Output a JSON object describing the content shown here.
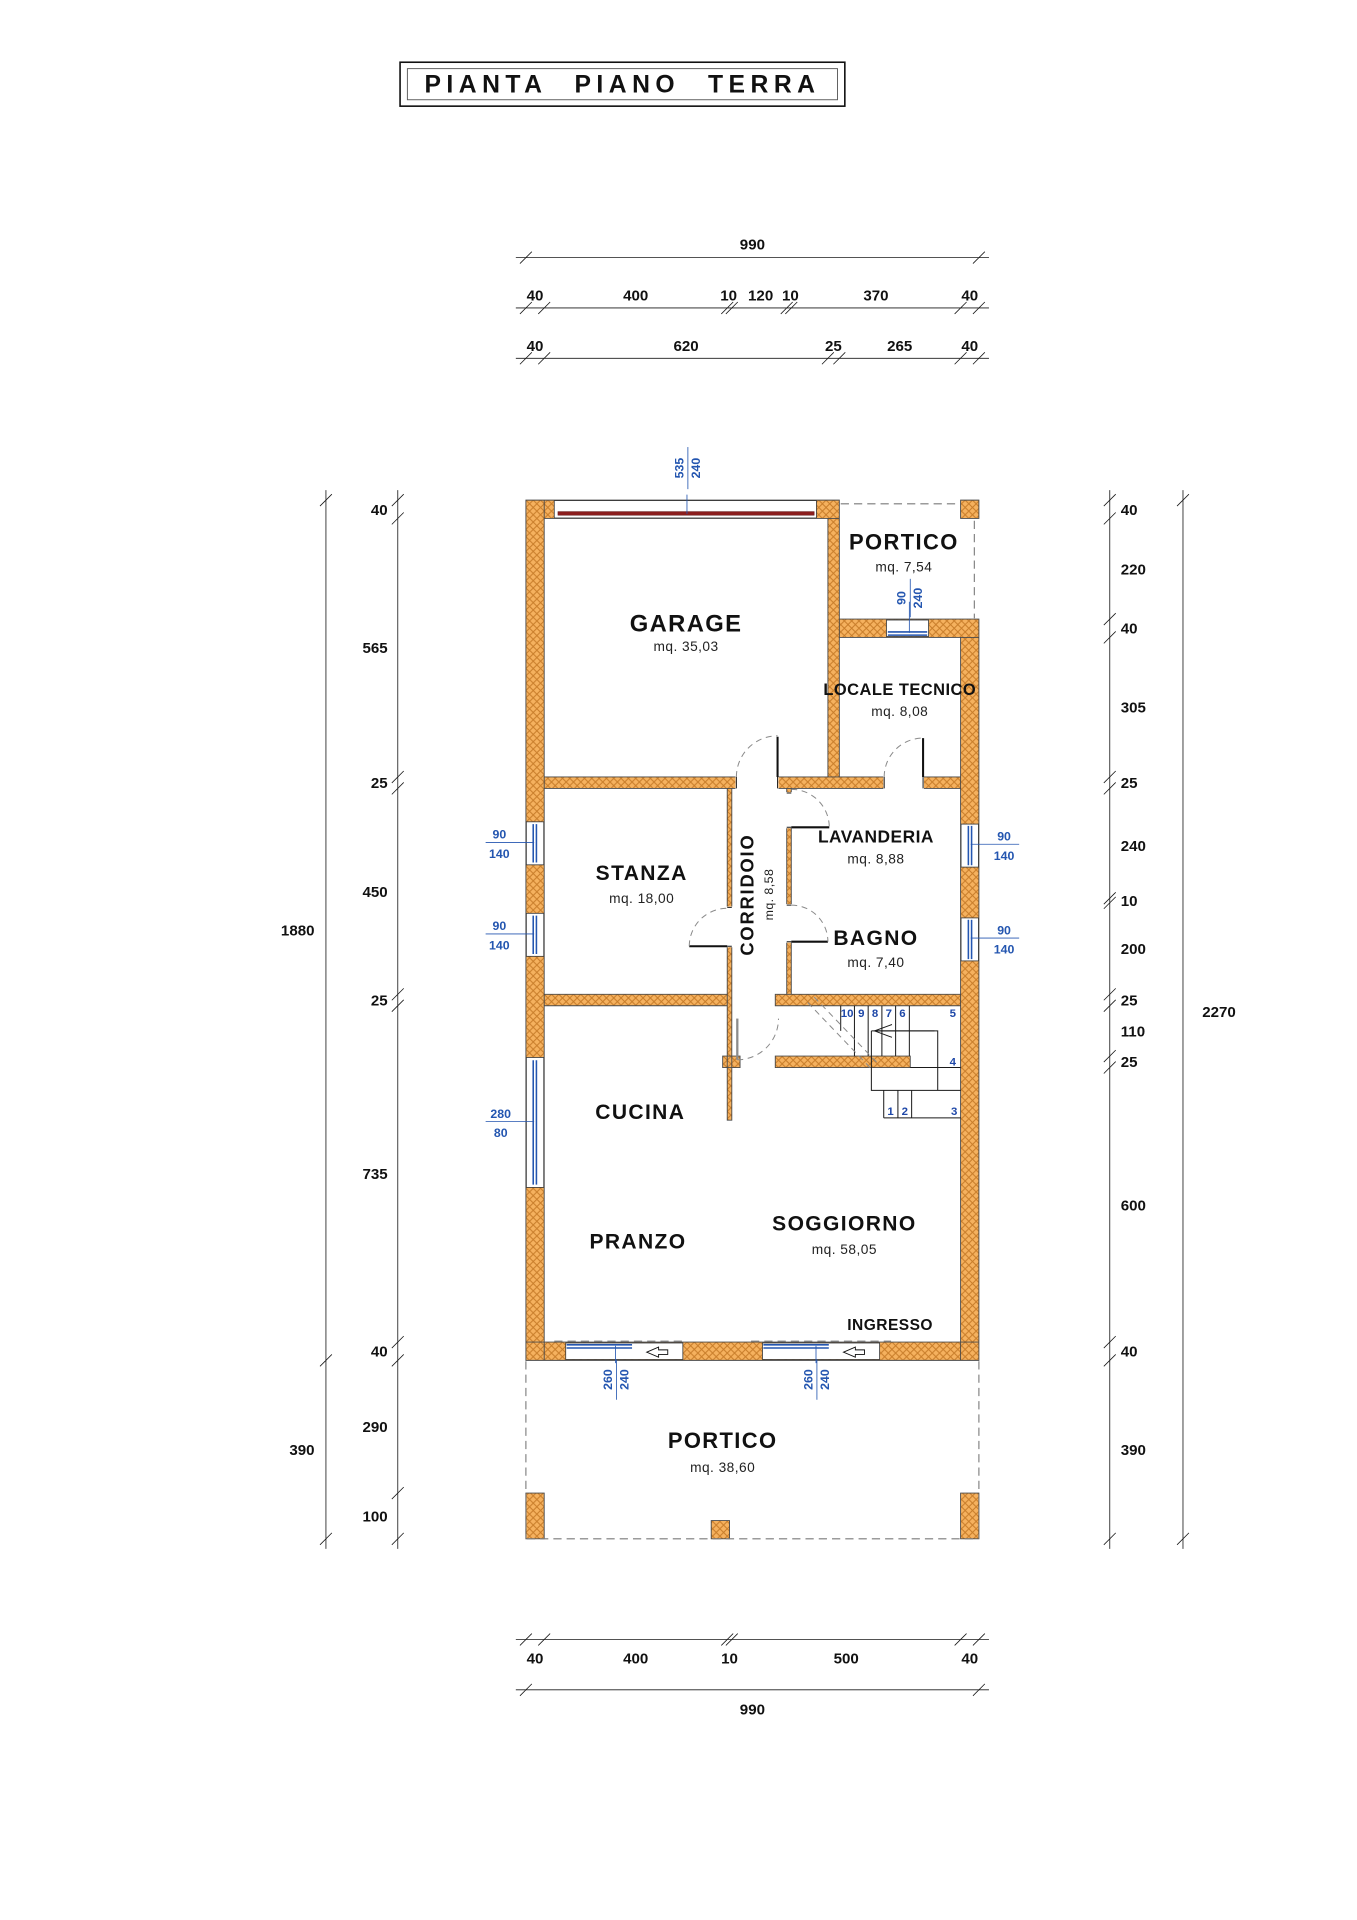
{
  "title": "PIANTA PIANO TERRA",
  "rooms": {
    "garage": {
      "name": "GARAGE",
      "area": "mq. 35,03"
    },
    "portico_top": {
      "name": "PORTICO",
      "area": "mq. 7,54"
    },
    "locale_tecnico": {
      "name": "LOCALE TECNICO",
      "area": "mq. 8,08"
    },
    "lavanderia": {
      "name": "LAVANDERIA",
      "area": "mq. 8,88"
    },
    "bagno": {
      "name": "BAGNO",
      "area": "mq. 7,40"
    },
    "corridoio": {
      "name": "CORRIDOIO",
      "area": "mq. 8,58"
    },
    "stanza": {
      "name": "STANZA",
      "area": "mq. 18,00"
    },
    "cucina": {
      "name": "CUCINA"
    },
    "pranzo": {
      "name": "PRANZO"
    },
    "soggiorno": {
      "name": "SOGGIORNO",
      "area": "mq. 58,05"
    },
    "ingresso": {
      "name": "INGRESSO"
    },
    "portico_bottom": {
      "name": "PORTICO",
      "area": "mq. 38,60"
    }
  },
  "openings": {
    "garage_door": {
      "w": "535",
      "h": "240"
    },
    "portico_door": {
      "w": "90",
      "h": "240"
    },
    "window_small": {
      "w": "90",
      "h": "140"
    },
    "window_kitchen": {
      "w": "280",
      "h": "80"
    },
    "south_door": {
      "w": "260",
      "h": "240"
    }
  },
  "stairs": {
    "numbers": [
      "1",
      "2",
      "3",
      "4",
      "5",
      "6",
      "7",
      "8",
      "9",
      "10"
    ]
  },
  "dimensions": {
    "top_overall": "990",
    "top_row2": [
      "40",
      "400",
      "10",
      "120",
      "10",
      "370",
      "40"
    ],
    "top_row3": [
      "40",
      "620",
      "25",
      "265",
      "40"
    ],
    "bottom_row": [
      "40",
      "400",
      "10",
      "500",
      "40"
    ],
    "bottom_overall": "990",
    "left_segments": [
      "40",
      "565",
      "25",
      "450",
      "25",
      "735",
      "40",
      "290",
      "100"
    ],
    "left_overall": "1880",
    "left_portico": "390",
    "right_segments": [
      "40",
      "220",
      "40",
      "305",
      "25",
      "240",
      "10",
      "200",
      "25",
      "110",
      "25",
      "600",
      "40",
      "390"
    ],
    "right_overall": "2270"
  },
  "colors": {
    "wall_fill": "#f5b15e",
    "wall_hatch": "#c87d2a",
    "annotation_blue": "#2456b0",
    "garage_door_red": "#8b1e1e"
  }
}
